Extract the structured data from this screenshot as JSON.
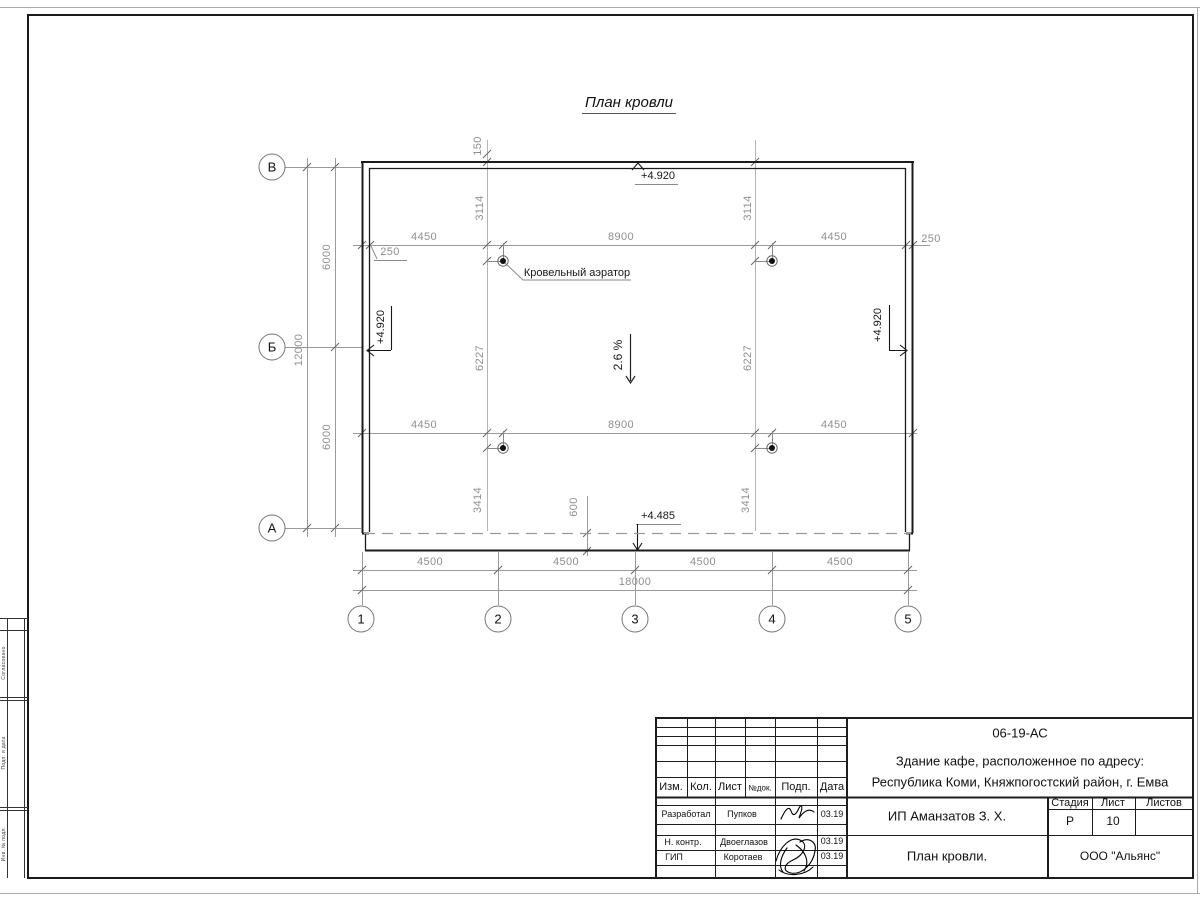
{
  "sheet": {
    "title": "План кровли",
    "margin_labels": [
      "Согласовано",
      "Подп. и дата",
      "Инв. № подл."
    ]
  },
  "plan": {
    "roof_aerator_label": "Кровельный аэратор",
    "slope_label": "2.6 %",
    "elevations": {
      "top": "+4.920",
      "left": "+4.920",
      "right": "+4.920",
      "eave": "+4.485"
    },
    "axes": {
      "rows": [
        "В",
        "Б",
        "А"
      ],
      "cols": [
        "1",
        "2",
        "3",
        "4",
        "5"
      ]
    },
    "dims": {
      "row_spacing": [
        "6000",
        "6000"
      ],
      "row_total": "12000",
      "col_spacing": [
        "4500",
        "4500",
        "4500",
        "4500"
      ],
      "col_total": "18000",
      "aerator_top": [
        "4450",
        "8900",
        "4450"
      ],
      "aerator_bottom": [
        "4450",
        "8900",
        "4450"
      ],
      "offset_left": "250",
      "offset_right": "250",
      "overhang_top": "150",
      "v_top": [
        "3114",
        "3114"
      ],
      "v_mid": [
        "6227",
        "6227"
      ],
      "v_bottom": [
        "3414",
        "3414"
      ],
      "eave_width": "600"
    }
  },
  "titleblock": {
    "doc_number": "06-19-АС",
    "object_line1": "Здание кафе, расположенное по адресу:",
    "object_line2": "Республика Коми, Княжпогостский район, г. Емва",
    "header_cols": [
      "Изм.",
      "Кол.",
      "Лист",
      "№док.",
      "Подп.",
      "Дата"
    ],
    "rows": [
      {
        "role": "Разработал",
        "name": "Пупков",
        "date": "03.19"
      },
      {
        "role": "Н. контр.",
        "name": "Двоеглазов",
        "date": "03.19"
      },
      {
        "role": "ГИП",
        "name": "Коротаев",
        "date": "03.19"
      }
    ],
    "client": "ИП Аманзатов З. Х.",
    "sheet_title": "План кровли.",
    "company": "ООО \"Альянс\"",
    "stage_header": [
      "Стадия",
      "Лист",
      "Листов"
    ],
    "stage": "Р",
    "sheet_no": "10",
    "sheets_total": ""
  }
}
